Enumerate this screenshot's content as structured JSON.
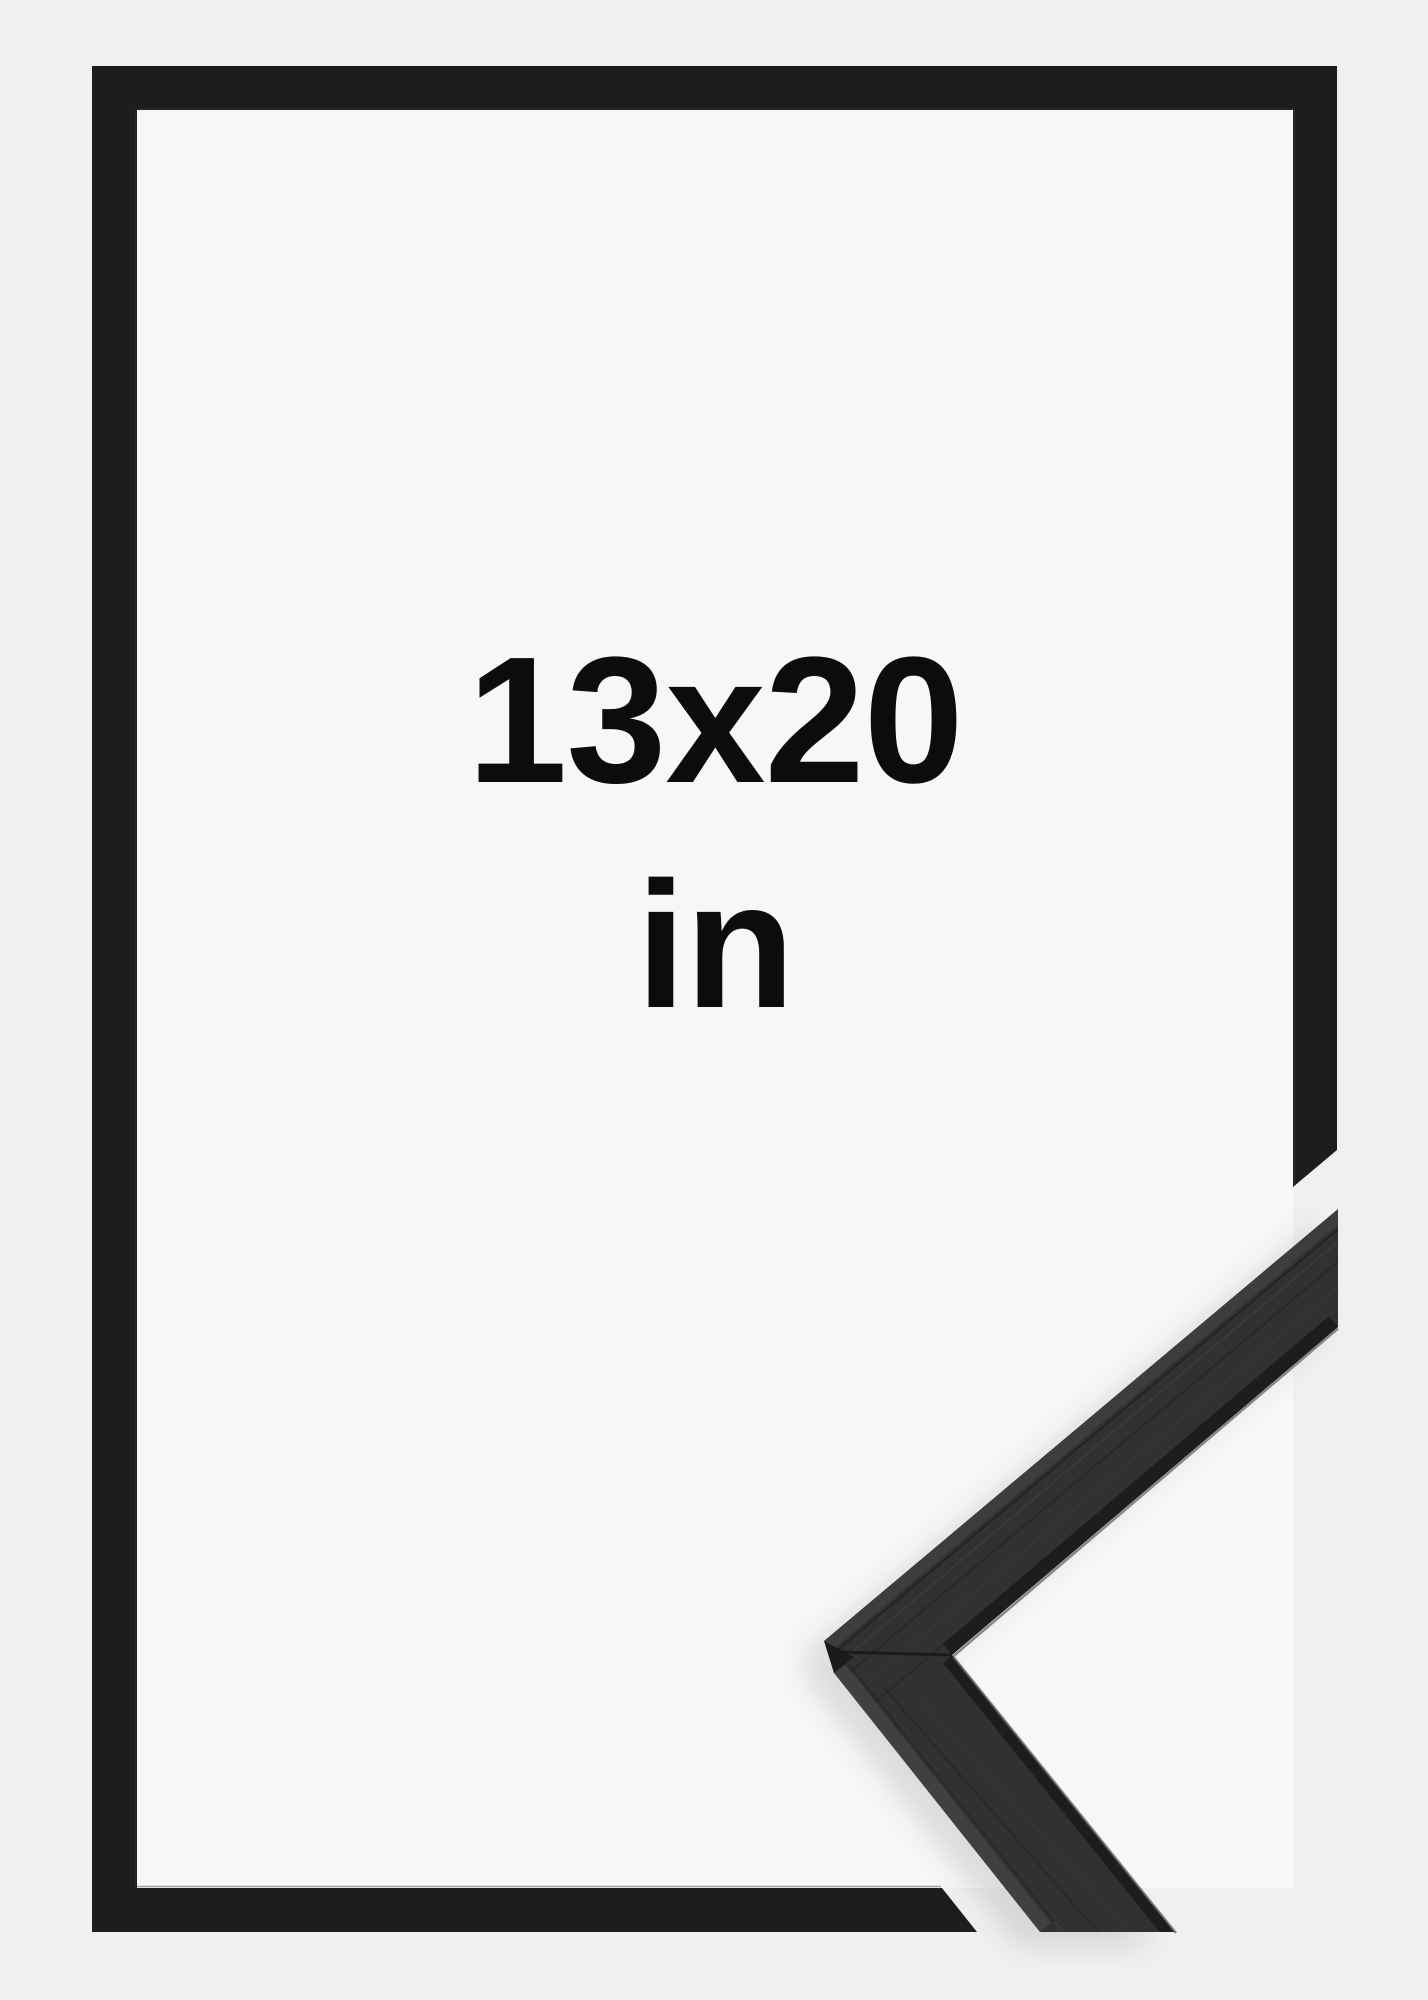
{
  "size_label": {
    "value": "13x20",
    "unit": "in"
  },
  "colors": {
    "page_background": "#eff0f1",
    "mat_background": "#f7f7f8",
    "frame_black": "#1d1d1d",
    "moulding_gray": "#2e2e2e",
    "label_text": "#0c0c0c"
  }
}
